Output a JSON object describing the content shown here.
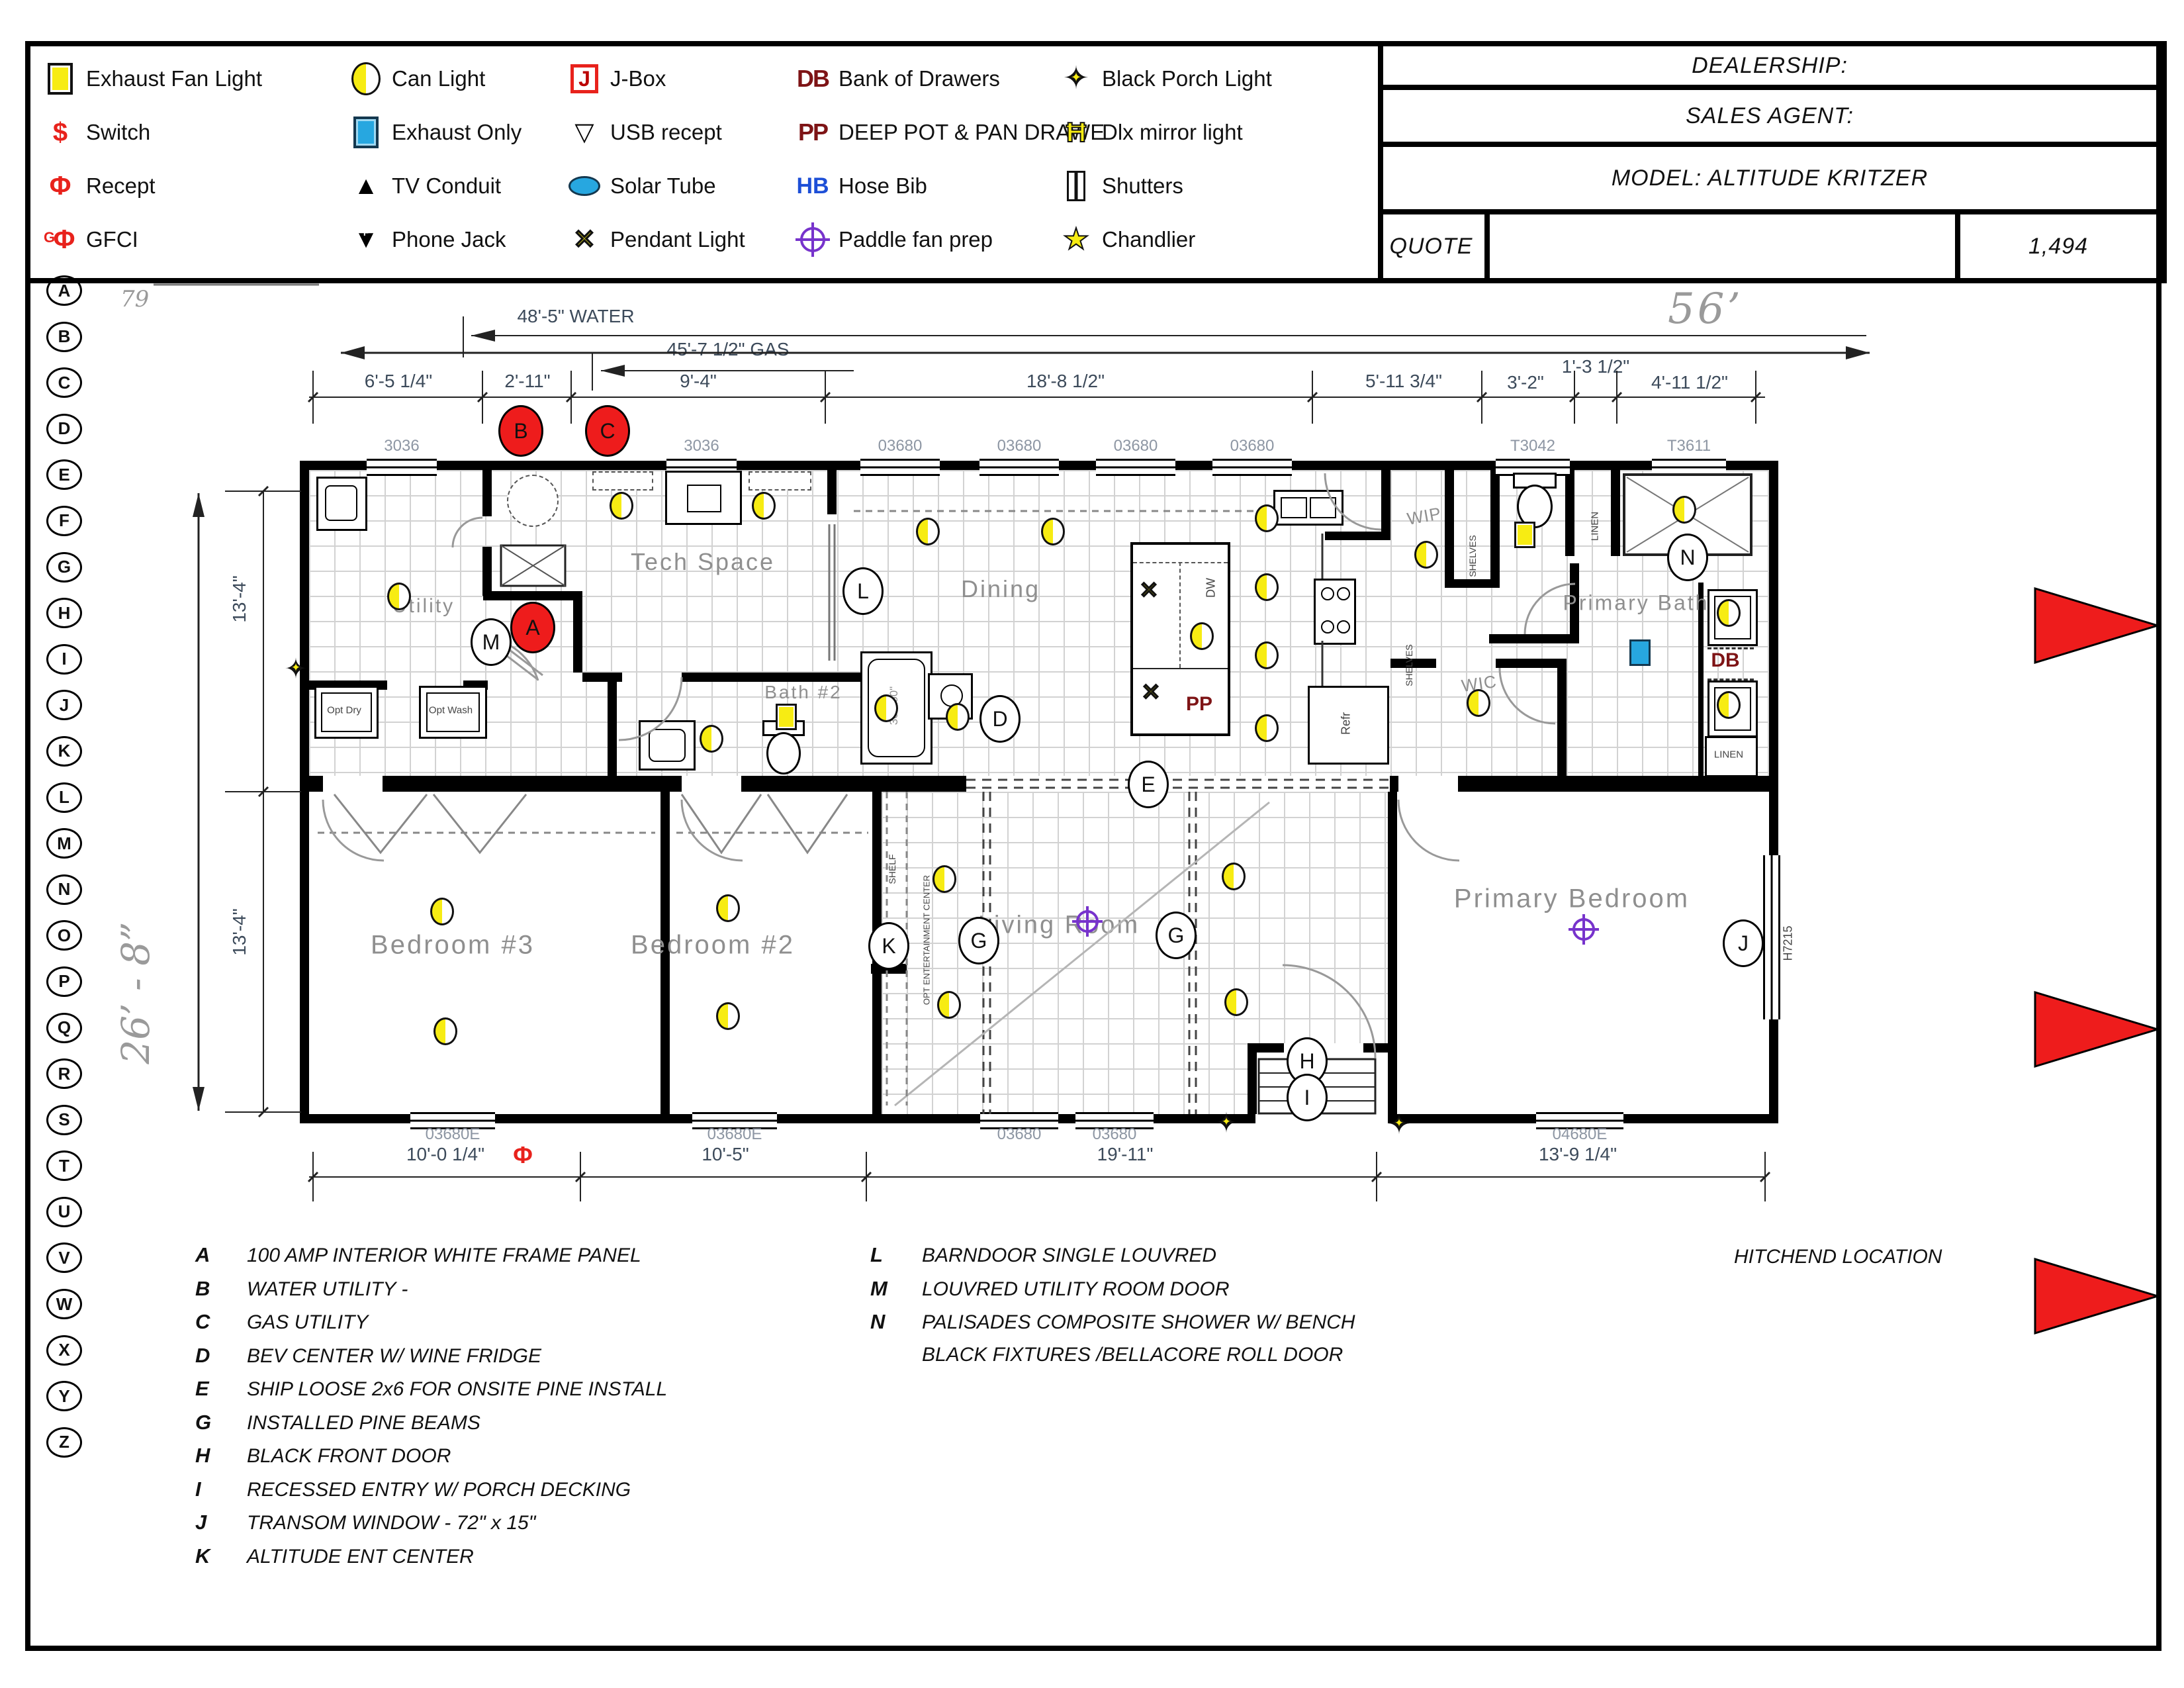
{
  "titleblock": {
    "dealership": "DEALERSHIP:",
    "sales_agent": "SALES AGENT:",
    "model": "MODEL:  ALTITUDE KRITZER",
    "quote": "QUOTE",
    "quote_value": "1,494"
  },
  "legend": {
    "columns": [
      [
        {
          "label": "Exhaust Fan Light",
          "icon": "exhaust-fan-light-icon",
          "cls": "licon sq-yellow"
        },
        {
          "label": "Switch",
          "icon": "switch-icon",
          "cls": "licon txt-red",
          "glyph": "$"
        },
        {
          "label": "Recept",
          "icon": "recept-icon",
          "cls": "licon txt-red",
          "glyph": "Φ"
        },
        {
          "label": "GFCI",
          "icon": "gfci-icon",
          "cls": "licon txt-red gfci",
          "glyph": "Φ",
          "sub": "G"
        }
      ],
      [
        {
          "label": "Can Light",
          "icon": "can-light-icon",
          "cls": "licon can"
        },
        {
          "label": "Exhaust Only",
          "icon": "exhaust-only-icon",
          "cls": "licon sq-blue"
        },
        {
          "label": "TV Conduit",
          "icon": "tv-conduit-icon",
          "cls": "licon txt-black",
          "glyph": "▲"
        },
        {
          "label": "Phone Jack",
          "icon": "phone-jack-icon",
          "cls": "licon txt-black phone",
          "glyph": "▼",
          "sub": "F"
        }
      ],
      [
        {
          "label": "J-Box",
          "icon": "j-box-icon",
          "cls": "licon jbox",
          "glyph": "J"
        },
        {
          "label": "USB recept",
          "icon": "usb-recept-icon",
          "cls": "licon txt-black",
          "glyph": "▽"
        },
        {
          "label": "Solar Tube",
          "icon": "solar-tube-icon",
          "cls": "licon solar"
        },
        {
          "label": "Pendant Light",
          "icon": "pendant-light-icon",
          "cls": "licon pendant",
          "glyph": "✕"
        }
      ],
      [
        {
          "label": "Bank of Drawers",
          "icon": "bank-of-drawers-icon",
          "cls": "licon txt-maroon",
          "glyph": "DB"
        },
        {
          "label": "DEEP POT & PAN DRAWE",
          "icon": "deep-pot-pan-drawer-icon",
          "cls": "licon txt-maroon",
          "glyph": "PP"
        },
        {
          "label": "Hose Bib",
          "icon": "hose-bib-icon",
          "cls": "licon txt-blue",
          "glyph": "HB"
        },
        {
          "label": "Paddle fan prep",
          "icon": "paddle-fan-prep-icon",
          "cls": "licon paddle"
        }
      ],
      [
        {
          "label": "Black Porch Light",
          "icon": "black-porch-light-icon",
          "cls": "licon porch",
          "glyph": "✦",
          "sub": "✦"
        },
        {
          "label": "Dlx mirror light",
          "icon": "dlx-mirror-light-icon",
          "cls": "licon mirror",
          "glyph": "Ħ"
        },
        {
          "label": "Shutters",
          "icon": "shutters-icon",
          "cls": "licon shutters"
        },
        {
          "label": "Chandlier",
          "icon": "chandlier-icon",
          "cls": "licon chand",
          "glyph": "★"
        }
      ]
    ]
  },
  "sheet_letters": [
    "A",
    "B",
    "C",
    "D",
    "E",
    "F",
    "G",
    "H",
    "I",
    "J",
    "K",
    "L",
    "M",
    "N",
    "O",
    "P",
    "Q",
    "R",
    "S",
    "T",
    "U",
    "V",
    "W",
    "X",
    "Y",
    "Z"
  ],
  "annotations": {
    "hand_number": "79",
    "hitchend": "HITCHEND LOCATION"
  },
  "plan": {
    "overall_width": "56’",
    "overall_depth": "26’ - 8”",
    "water": "48'-5\" WATER",
    "gas": "45'-7 1/2\" GAS",
    "top_dims": [
      "6'-5 1/4\"",
      "2'-11\"",
      "9'-4\"",
      "18'-8 1/2\"",
      "5'-11 3/4\"",
      "3'-2\"",
      "1'-3 1/2\"",
      "4'-11 1/2\""
    ],
    "side_dims": [
      "13'-4\"",
      "13'-4\""
    ],
    "bottom_dims": [
      "10'-0 1/4\"",
      "10'-5\"",
      "19'-11\"",
      "13'-9 1/4\""
    ],
    "top_windows": [
      "3036",
      "3036",
      "03680",
      "03680",
      "03680",
      "03680",
      "T3042",
      "T3611"
    ],
    "bottom_windows": [
      "03680E",
      "03680E",
      "03680",
      "03680",
      "04680E"
    ],
    "rooms": {
      "utility": "Utility",
      "tech": "Tech Space",
      "dining": "Dining",
      "bath2": "Bath #2",
      "primary_bath": "Primary Bath",
      "wip": "WIP",
      "wic": "WIC",
      "bed3": "Bedroom #3",
      "bed2": "Bedroom #2",
      "living": "Living Room",
      "primary_bed": "Primary Bedroom"
    },
    "fixtures": {
      "furn": "FURN",
      "opt_dry": "Opt Dry",
      "opt_wash": "Opt Wash",
      "dw": "DW",
      "pp": "PP",
      "refr": "Refr",
      "shelves": "SHELVES",
      "shelf": "SHELF",
      "ent_center": "OPT ENTERTAINMENT CENTER",
      "linen": "LINEN",
      "db": "DB",
      "shower_size": "42\"x60\"",
      "tub_size": "30\"x60\"",
      "transom_tag": "H7215"
    },
    "markers": {
      "a": "A",
      "b": "B",
      "c": "C",
      "d": "D",
      "e": "E",
      "g": "G",
      "h": "H",
      "i": "I",
      "j": "J",
      "k": "K",
      "l": "L",
      "m": "M",
      "n": "N"
    }
  },
  "notes": {
    "left": [
      {
        "key": "A",
        "text": "100 AMP INTERIOR WHITE FRAME PANEL"
      },
      {
        "key": "B",
        "text": "WATER UTILITY -"
      },
      {
        "key": "C",
        "text": "GAS UTILITY"
      },
      {
        "key": "D",
        "text": "BEV CENTER W/ WINE FRIDGE"
      },
      {
        "key": "E",
        "text": "SHIP LOOSE 2x6 FOR ONSITE PINE INSTALL"
      },
      {
        "key": "G",
        "text": "INSTALLED PINE BEAMS"
      },
      {
        "key": "H",
        "text": "BLACK FRONT DOOR"
      },
      {
        "key": "I",
        "text": "RECESSED ENTRY W/ PORCH DECKING"
      },
      {
        "key": "J",
        "text": "TRANSOM WINDOW - 72\" x 15\""
      },
      {
        "key": "K",
        "text": "ALTITUDE ENT CENTER"
      }
    ],
    "right": [
      {
        "key": "L",
        "text": "BARNDOOR SINGLE LOUVRED"
      },
      {
        "key": "M",
        "text": "LOUVRED UTILITY ROOM DOOR"
      },
      {
        "key": "N",
        "text": "PALISADES COMPOSITE SHOWER W/ BENCH"
      },
      {
        "key": "",
        "text": "BLACK FIXTURES /BELLACORE ROLL DOOR"
      }
    ]
  },
  "icons": {
    "pendant_x": "✕",
    "porch_star_outer": "✦",
    "porch_star_inner": "✦"
  },
  "colors": {
    "accent_red": "#ee1c1c",
    "symbol_yellow": "#f7ec13",
    "symbol_blue": "#27a7e0",
    "maroon": "#7e1416",
    "purple": "#7733cc"
  }
}
